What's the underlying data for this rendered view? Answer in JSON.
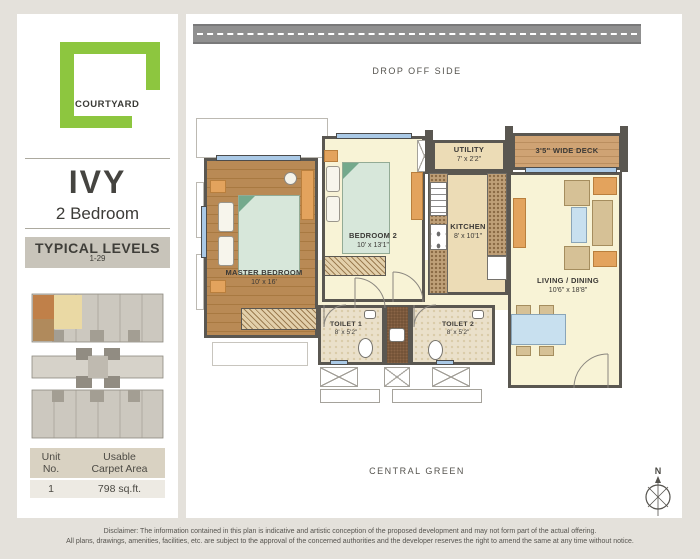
{
  "colors": {
    "brand_green": "#8dc63f",
    "highlight_orange": "#c08049"
  },
  "sidebar": {
    "logo_text": "COURTYARD",
    "unit_name": "IVY",
    "unit_type": "2 Bedroom",
    "levels_title": "TYPICAL LEVELS",
    "levels_range": "1-29",
    "table": {
      "col1_header": "Unit\nNo.",
      "col2_header": "Usable\nCarpet Area",
      "unit_no": "1",
      "carpet_area": "798 sq.ft."
    }
  },
  "plan": {
    "top_label": "DROP OFF SIDE",
    "bottom_label": "CENTRAL GREEN",
    "compass": "N",
    "rooms": {
      "master": {
        "name": "MASTER BEDROOM",
        "dims": "10' x 16'"
      },
      "bedroom2": {
        "name": "BEDROOM 2",
        "dims": "10' x 13'1\""
      },
      "kitchen": {
        "name": "KITCHEN",
        "dims": "8' x 10'1\""
      },
      "utility": {
        "name": "UTILITY",
        "dims": "7' x 2'2\""
      },
      "living": {
        "name": "LIVING / DINING",
        "dims": "10'6\" x 18'8\""
      },
      "toilet1": {
        "name": "TOILET 1",
        "dims": "8' x 5'2\""
      },
      "toilet2": {
        "name": "TOILET 2",
        "dims": "8' x 5'2\""
      },
      "deck": {
        "name": "3'5\" WIDE DECK"
      }
    }
  },
  "footer": {
    "disclaimer_line1": "Disclaimer: The information contained in this plan is indicative and artistic conception of the proposed development and may not form part of the actual offering.",
    "disclaimer_line2": "All plans, drawings, amenities, facilities, etc. are subject to the approval of the concerned authorities and the developer reserves the right to amend the same at any time without notice."
  }
}
